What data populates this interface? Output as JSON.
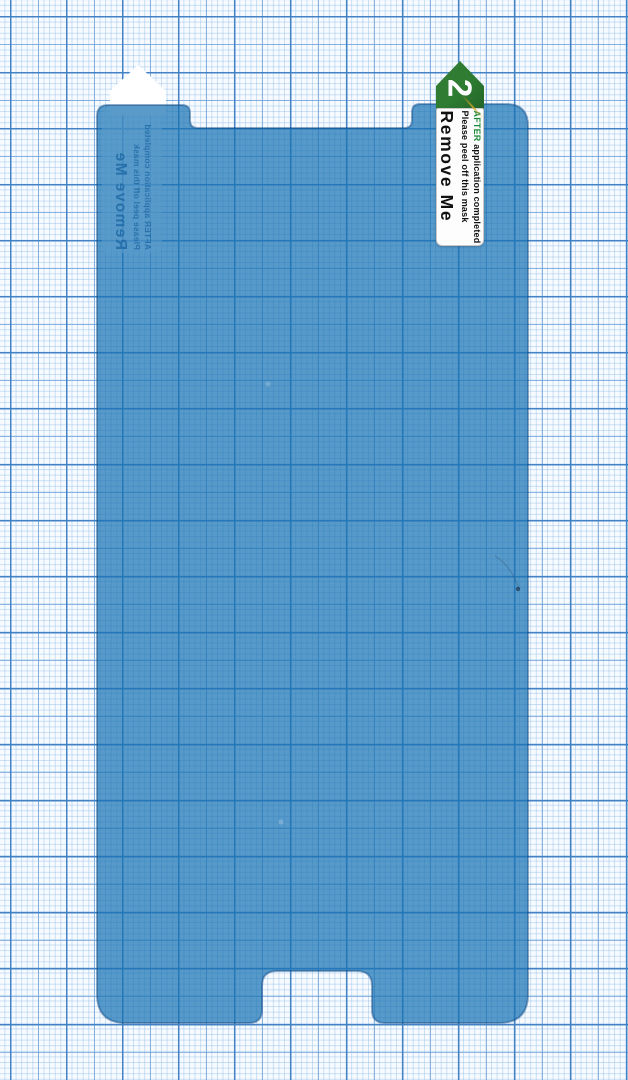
{
  "front_tab": {
    "step_number": "2",
    "title": "Remove Me",
    "instruction_line": "Please peel off this mask",
    "emphasis_word": "AFTER",
    "instruction_rest": " application completed"
  },
  "back_tab": {
    "title": "Remove Me",
    "instruction_line": "Please peel off this mask",
    "instruction_line2": "AFTER application completed"
  },
  "colors": {
    "film_blue": "#4f9ccf",
    "grid_bold_line": "#3e7fc4",
    "grid_medium_line": "#7fb3e2",
    "grid_fine_line": "#bcd8ef",
    "paper_background": "#f7fbff",
    "tab_arrow_green": "#2e7d32",
    "emphasis_green": "#1d8a3a"
  }
}
